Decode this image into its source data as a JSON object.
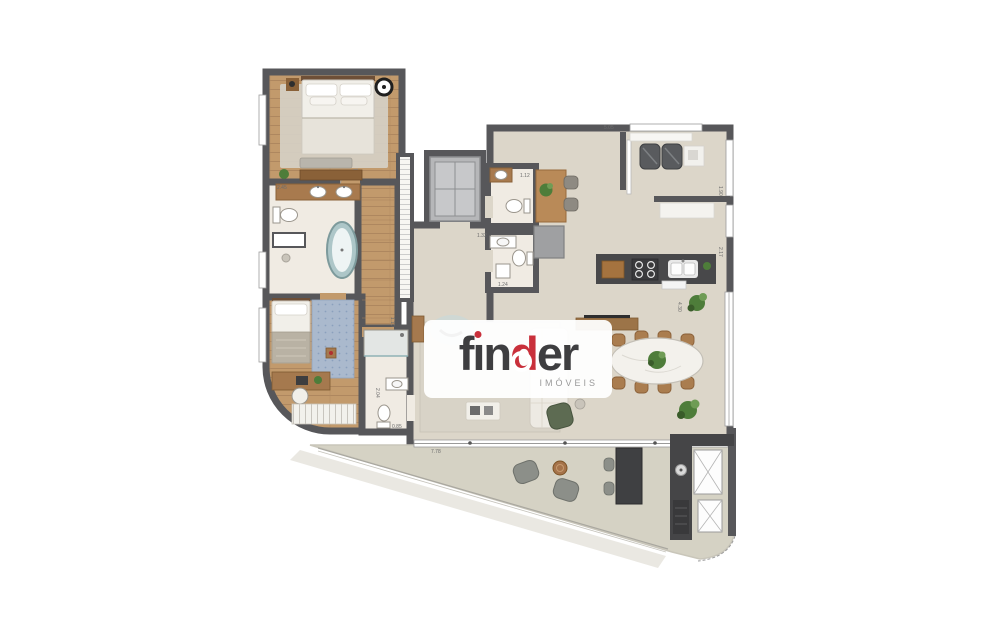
{
  "logo": {
    "brand": "finder",
    "brand_p1": "f",
    "brand_i": "ı",
    "brand_p2": "n",
    "brand_accent": "d",
    "brand_p3": "er",
    "subtitle": "IMÓVEIS",
    "accent_color": "#c9303b",
    "text_color": "#3e3e40"
  },
  "colors": {
    "wall": "#57575a",
    "wood_floor": "#c29a6c",
    "stone_floor": "#dcd6c9",
    "bath_floor": "#f0ebe3",
    "terrace_floor": "#d5d2c4",
    "counter_dark": "#48484a",
    "plant_green": "#4e7d3a"
  },
  "dimensions": [
    {
      "value": "2.45",
      "x": 277,
      "y": 189,
      "rot": 0
    },
    {
      "value": "5.05",
      "x": 604,
      "y": 129,
      "rot": 0
    },
    {
      "value": "1.12",
      "x": 520,
      "y": 177,
      "rot": 0
    },
    {
      "value": "1.32",
      "x": 477,
      "y": 237,
      "rot": 0
    },
    {
      "value": "1.24",
      "x": 498,
      "y": 286,
      "rot": 0
    },
    {
      "value": "1.90",
      "x": 719,
      "y": 186,
      "rot": 90
    },
    {
      "value": "2.17",
      "x": 719,
      "y": 247,
      "rot": 90
    },
    {
      "value": "4.30",
      "x": 678,
      "y": 302,
      "rot": 90
    },
    {
      "value": "1.10",
      "x": 391,
      "y": 317,
      "rot": 90
    },
    {
      "value": "2.04",
      "x": 376,
      "y": 388,
      "rot": 90
    },
    {
      "value": "0.85",
      "x": 392,
      "y": 428,
      "rot": 0
    },
    {
      "value": "7.78",
      "x": 431,
      "y": 453,
      "rot": 0
    }
  ]
}
